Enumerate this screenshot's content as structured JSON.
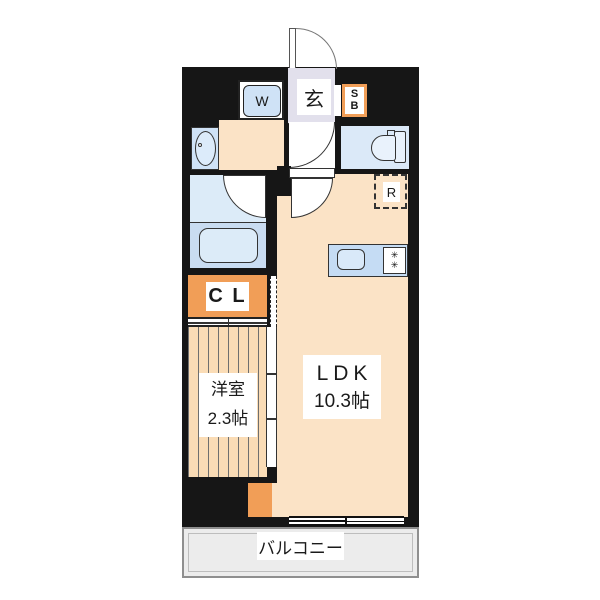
{
  "plan_type": "apartment-floor-plan",
  "labels": {
    "entrance": "玄",
    "washer": "W",
    "shoebox_top": "S",
    "shoebox_bottom": "B",
    "fridge": "R",
    "closet": "C L",
    "western_room": "洋室",
    "western_room_size": "2.3帖",
    "ldk": "LDK",
    "ldk_size": "10.3帖",
    "balcony": "バルコニー",
    "burner_glyph": "✳"
  },
  "colors": {
    "wall": "#161616",
    "floor_peach": "#fbe3c6",
    "western_room_floor": "#fadcb6",
    "accent_orange": "#f19e57",
    "wet_area_blue": "#dcebf8",
    "kitchen_counter_blue": "#c5dcf4",
    "entrance_gray": "#e2e0ec",
    "balcony_gray": "#ececec",
    "outline": "#333333"
  }
}
